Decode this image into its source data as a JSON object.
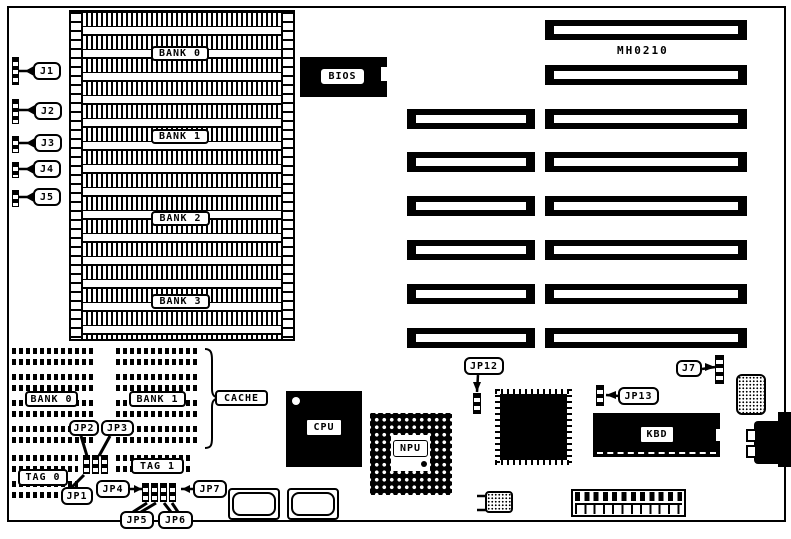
{
  "board": {
    "model": "MH0210"
  },
  "memory": {
    "bank0": "BANK 0",
    "bank1": "BANK 1",
    "bank2": "BANK 2",
    "bank3": "BANK 3"
  },
  "left_connectors": {
    "j1": "J1",
    "j2": "J2",
    "j3": "J3",
    "j4": "J4",
    "j5": "J5"
  },
  "chips": {
    "bios": "BIOS",
    "cpu": "CPU",
    "npu": "NPU",
    "kbd": "KBD"
  },
  "cache": {
    "bank0": "BANK 0",
    "bank1": "BANK 1",
    "label": "CACHE",
    "tag0": "TAG 0",
    "tag1": "TAG 1"
  },
  "jumpers": {
    "jp1": "JP1",
    "jp2": "JP2",
    "jp3": "JP3",
    "jp4": "JP4",
    "jp5": "JP5",
    "jp6": "JP6",
    "jp7": "JP7",
    "jp12": "JP12",
    "jp13": "JP13",
    "j7": "J7"
  },
  "colors": {
    "ink": "#000000",
    "paper": "#ffffff"
  }
}
